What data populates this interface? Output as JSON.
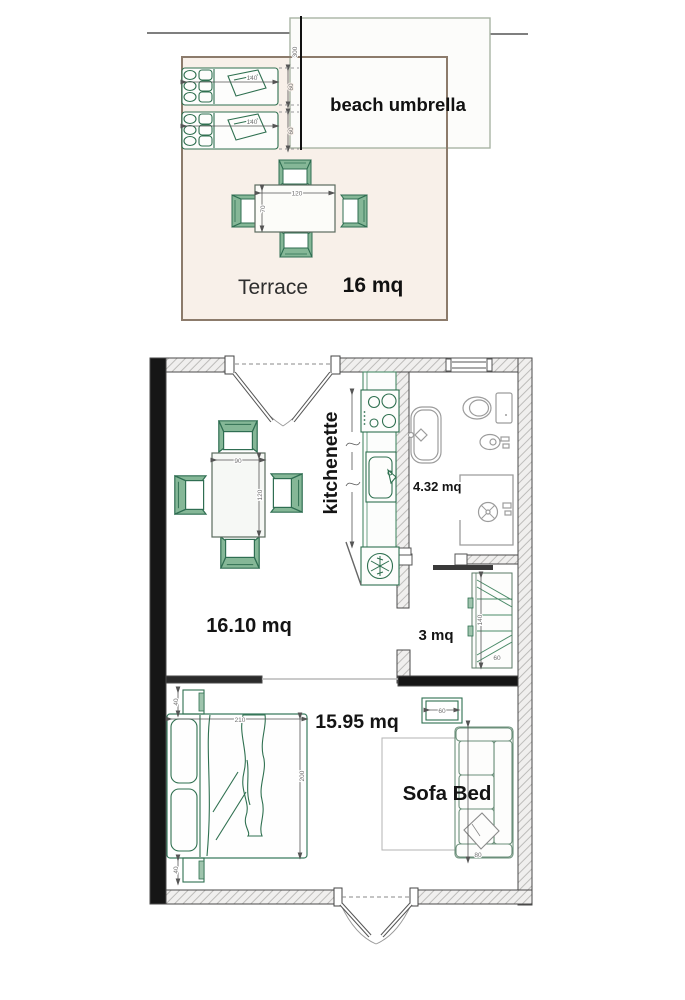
{
  "labels": {
    "beach_umbrella": "beach umbrella",
    "terrace": "Terrace",
    "terrace_area": "16 mq",
    "kitchenette": "kitchenette",
    "bathroom_area": "4.32 mq",
    "living_area": "16.10 mq",
    "closet_area": "3 mq",
    "bedroom_area": "15.95 mq",
    "sofa_bed": "Sofa Bed"
  },
  "dimensions_cm": {
    "terrace_boundary": "300",
    "sun_lounger_length": "140",
    "sun_lounger_width": "60",
    "terrace_table_length": "120",
    "terrace_table_width": "70",
    "dining_table_width": "90",
    "dining_table_length": "120",
    "bed_width": "210",
    "bed_length": "200",
    "nightstand_width": "40",
    "side_table_length": "60",
    "sofa_depth": "80",
    "wardrobe_length": "140",
    "wardrobe_depth": "60"
  },
  "colors": {
    "furniture_green": "#2f7050",
    "chair_fill_green": "#85b797",
    "terrace_fill": "#f8f0e9",
    "terrace_border": "#8c7b6b",
    "wall_black": "#161616",
    "wall_hatch_line": "#bdbcba",
    "fixture_gray": "#9c9c9c"
  }
}
